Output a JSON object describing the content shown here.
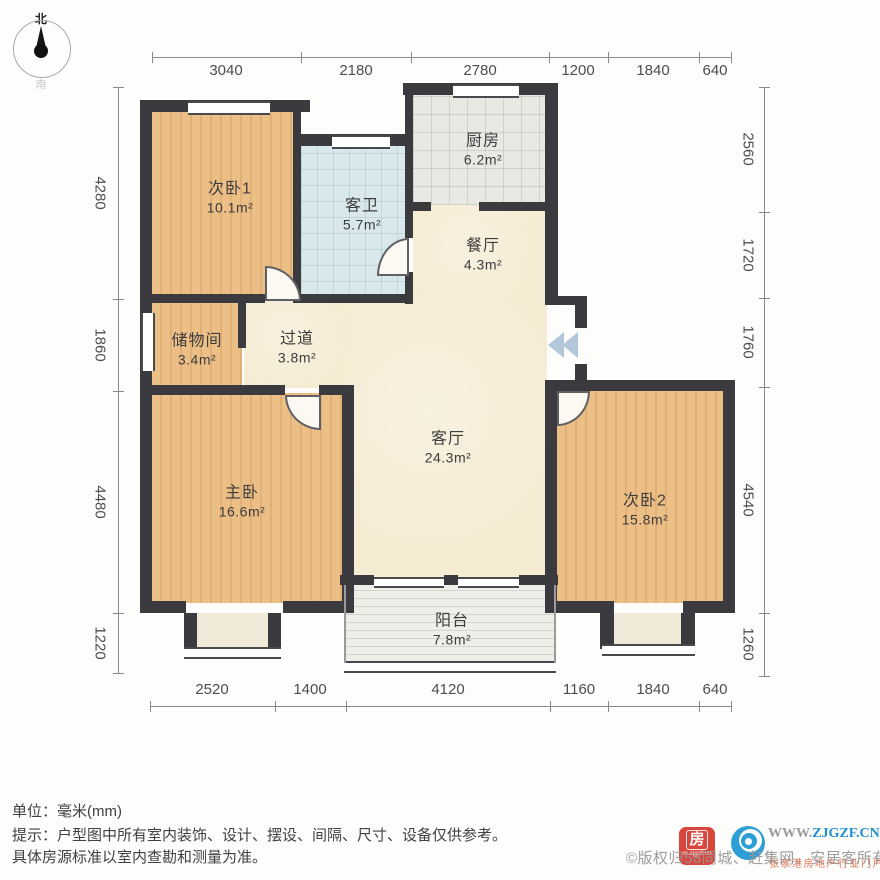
{
  "compass": {
    "north": "北",
    "south": "南"
  },
  "rooms": {
    "bedroom1": {
      "name": "次卧1",
      "area": "10.1m²"
    },
    "bath": {
      "name": "客卫",
      "area": "5.7m²"
    },
    "kitchen": {
      "name": "厨房",
      "area": "6.2m²"
    },
    "dining": {
      "name": "餐厅",
      "area": "4.3m²"
    },
    "storage": {
      "name": "储物间",
      "area": "3.4m²"
    },
    "hallway": {
      "name": "过道",
      "area": "3.8m²"
    },
    "living": {
      "name": "客厅",
      "area": "24.3m²"
    },
    "master": {
      "name": "主卧",
      "area": "16.6m²"
    },
    "bedroom2": {
      "name": "次卧2",
      "area": "15.8m²"
    },
    "balcony": {
      "name": "阳台",
      "area": "7.8m²"
    }
  },
  "dims": {
    "top": [
      "3040",
      "2180",
      "2780",
      "1200",
      "1840",
      "640"
    ],
    "bottom": [
      "2520",
      "1400",
      "4120",
      "1160",
      "1840",
      "640"
    ],
    "left": [
      "4280",
      "1860",
      "4480",
      "1220"
    ],
    "right": [
      "2560",
      "1720",
      "1760",
      "4540",
      "1260"
    ]
  },
  "footer": {
    "unit_note": "单位：毫米(mm)",
    "disclaimer_line1": "提示：户型图中所有室内装饰、设计、摆设、间隔、尺寸、设备仅供参考。",
    "disclaimer_line2": "具体房源标准以室内查勘和测量为准。"
  },
  "watermark": {
    "copyright": "©版权归58同城、赶集网、安居客所有",
    "site_www": "WWW.",
    "site_domain": "ZJGZF.CN",
    "site_slogan": "张家港房地产行业门户",
    "app_icon_char": "房",
    "app_icon_sub": "m.zjgzf.cn"
  },
  "colors": {
    "wall": "#3a3a3f",
    "wood_floor": "#ecbf87",
    "cream_floor": "#f6ecd4",
    "bath_tile": "#d9e9eb",
    "kitchen_tile": "#e9e9e3",
    "balcony_floor": "#edefe8",
    "site_blue": "#1e8fd0",
    "app_red": "#d8473e"
  }
}
